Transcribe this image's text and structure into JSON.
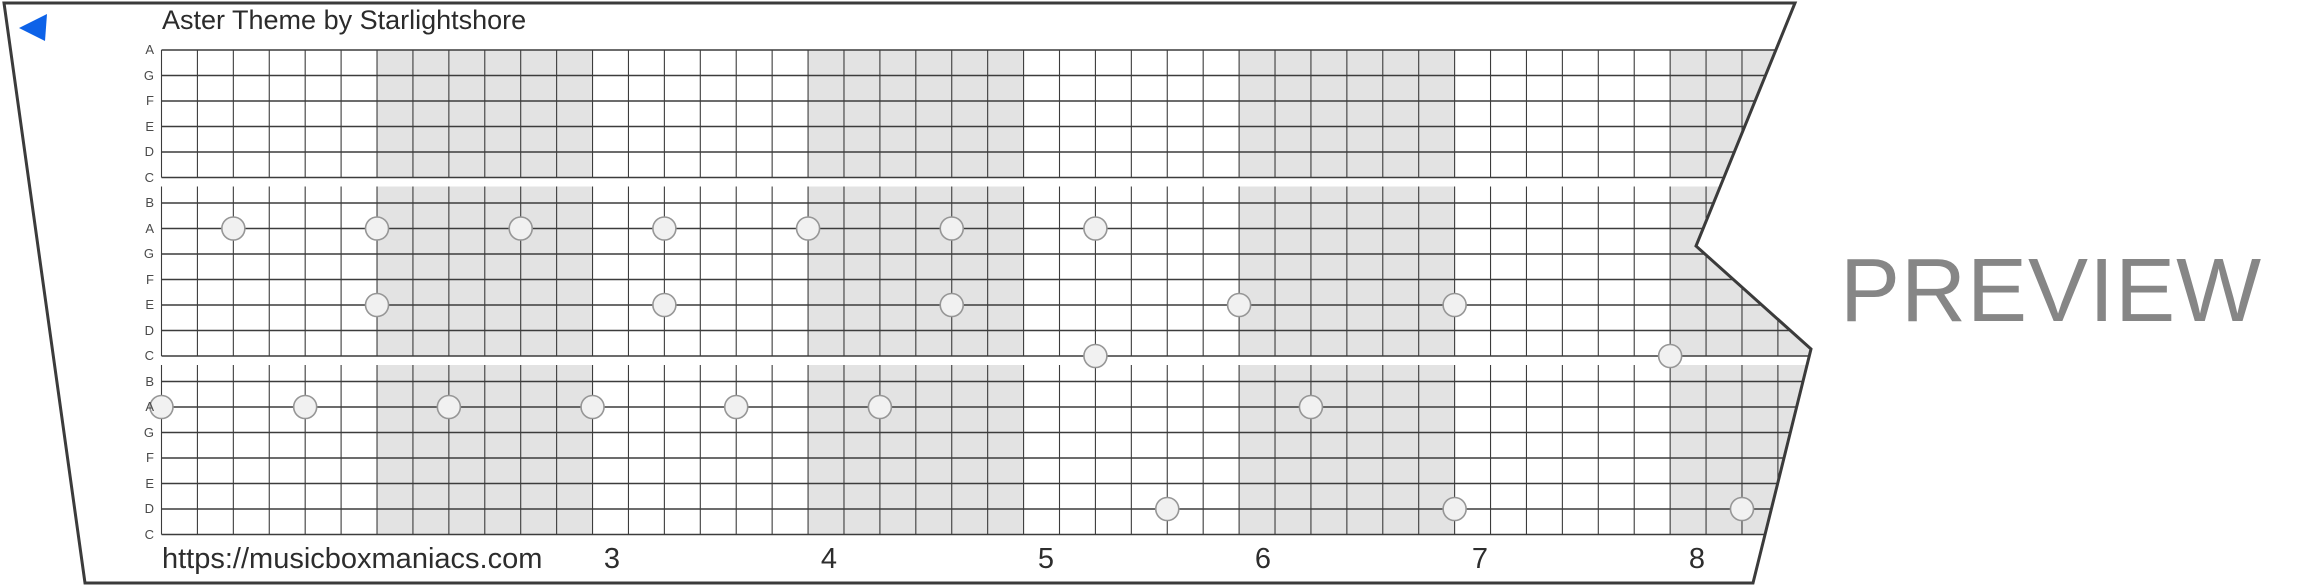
{
  "title": "Aster Theme by Starlightshore",
  "watermark": "PREVIEW",
  "footer": {
    "url": "https://musicboxmaniacs.com"
  },
  "row_labels": [
    "A",
    "G",
    "F",
    "E",
    "D",
    "C",
    "B",
    "A",
    "G",
    "F",
    "E",
    "D",
    "C",
    "B",
    "A",
    "G",
    "F",
    "E",
    "D",
    "C"
  ],
  "measures": {
    "numbers": [
      "3",
      "4",
      "5",
      "6",
      "7",
      "8"
    ],
    "xs": [
      612,
      829,
      1046,
      1263,
      1480,
      1697
    ]
  },
  "notes": [
    {
      "row": 7,
      "cells": [
        2,
        6,
        10,
        14,
        18,
        22,
        26
      ]
    },
    {
      "row": 10,
      "cells": [
        6,
        14,
        22,
        30,
        36
      ]
    },
    {
      "row": 12,
      "cells": [
        26,
        42
      ]
    },
    {
      "row": 14,
      "cells": [
        0,
        4,
        8,
        12,
        16,
        20,
        32
      ]
    },
    {
      "row": 18,
      "cells": [
        28,
        36,
        44
      ]
    }
  ],
  "layout": {
    "grid_left": 161.5,
    "cell_w": 35.92,
    "row_top": 50,
    "row_h": 25.5,
    "num_cols": 46,
    "label_left": 114,
    "blocks": [
      {
        "first_row": 0,
        "last_row": 5,
        "vtop": 50,
        "vbottom": 177.5
      },
      {
        "first_row": 6,
        "last_row": 12,
        "vtop": 186.5,
        "vbottom": 356
      },
      {
        "first_row": 13,
        "last_row": 19,
        "vtop": 365,
        "vbottom": 534.5
      }
    ],
    "shaded_band_xs": [
      377,
      808,
      1239,
      1670
    ],
    "band_w": 215.5,
    "note_r": 11.5,
    "strip_polygon": "4,3 1795,3 1696,246 1811,349 1753,583 85,583",
    "back_triangle": "19,28 47,14 45,41"
  },
  "colors": {
    "band": "#e3e3e3",
    "grid_line": "#3c3c3c",
    "outline": "#3b3b3b",
    "note_fill": "#f1f1f1",
    "note_stroke": "#969696",
    "accent_blue": "#0d62e8",
    "watermark": "#868686",
    "text": "#2b2b2b"
  }
}
